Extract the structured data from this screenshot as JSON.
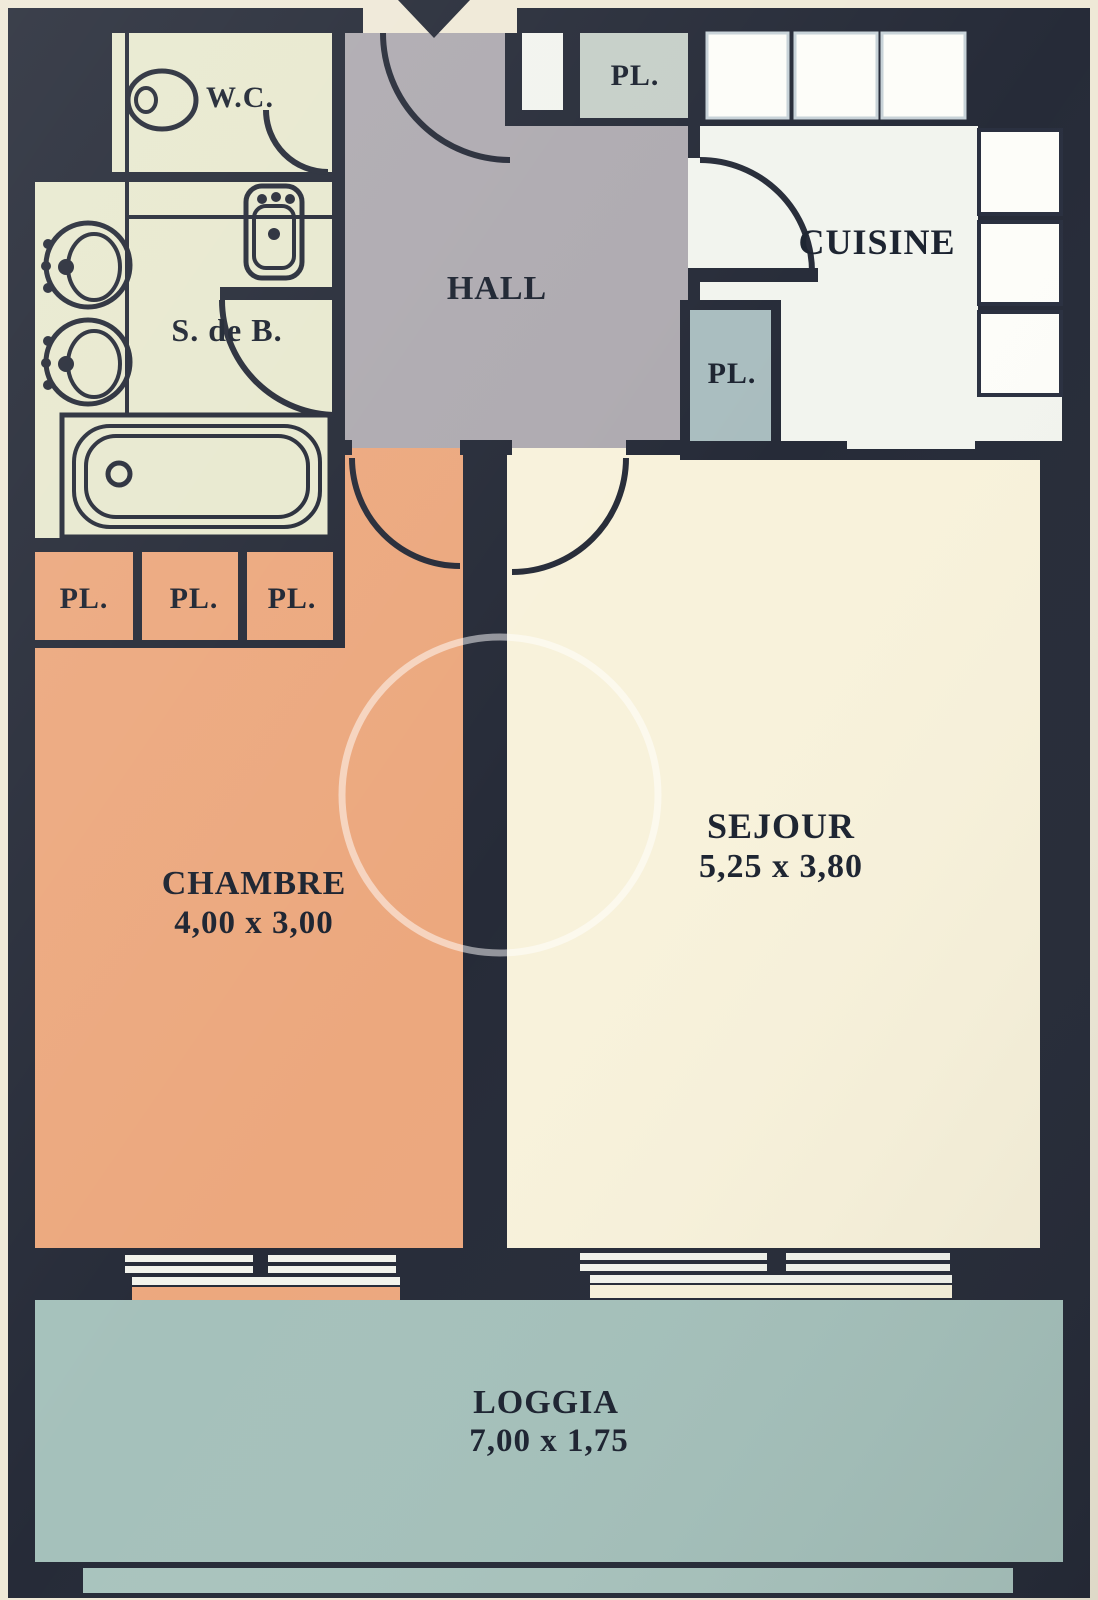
{
  "document": {
    "type": "apartment-floor-plan",
    "language": "French"
  },
  "colors": {
    "outer": "#efe9d7",
    "wall": "#262b38",
    "bathroom": "#e8e9cf",
    "hall": "#aeaab0",
    "closet_top": "#c6cfc8",
    "closet_kitchen": "#a9bdbf",
    "kitchen": "#f2f4ee",
    "counter": "#fdfdf9",
    "bedroom": "#eca87e",
    "living": "#f8f2db",
    "loggia": "#a5c1bb",
    "loggia_strip": "#a9c4be",
    "window_bar": "#f2f3ec",
    "text": "#1c2330"
  },
  "rooms": {
    "wc": {
      "label": "W.C."
    },
    "bathroom": {
      "label": "S. de B."
    },
    "hall": {
      "label": "HALL"
    },
    "entry_closet": {
      "label": "PL."
    },
    "kitchen": {
      "label": "CUISINE"
    },
    "kitchen_closet": {
      "label": "PL."
    },
    "closet_left": {
      "label": "PL."
    },
    "closet_middle": {
      "label": "PL."
    },
    "closet_right": {
      "label": "PL."
    },
    "bedroom": {
      "label": "CHAMBRE",
      "dimensions": "4,00 x 3,00"
    },
    "living": {
      "label": "SEJOUR",
      "dimensions": "5,25 x 3,80"
    },
    "loggia": {
      "label": "LOGGIA",
      "dimensions": "7,00 x 1,75"
    }
  },
  "fixtures": [
    "entrance-arrow",
    "toilet",
    "washbasin",
    "washer",
    "dryer",
    "bathtub",
    "kitchen-counters",
    "door-swings",
    "sliding-windows"
  ]
}
